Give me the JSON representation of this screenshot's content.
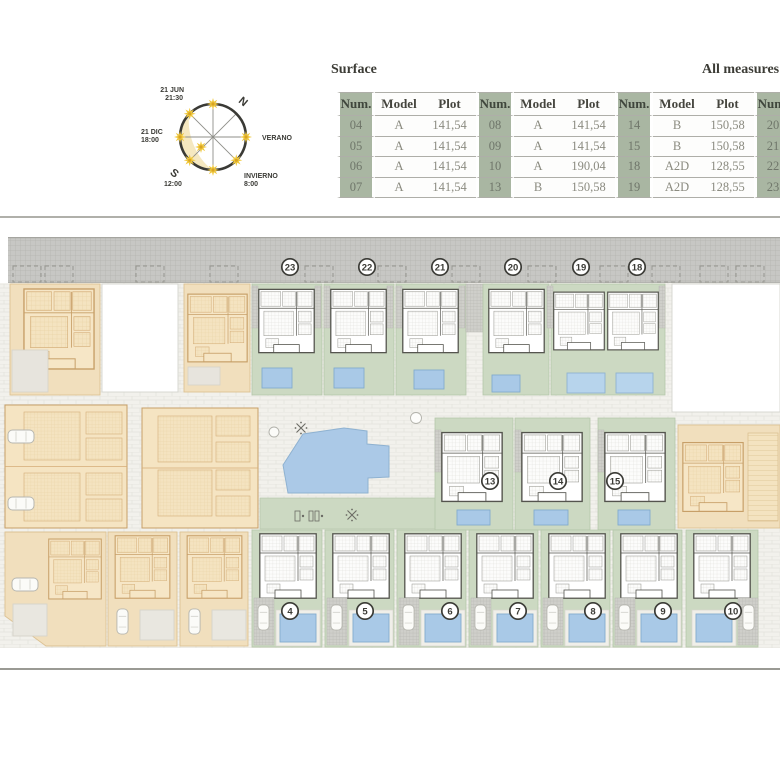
{
  "header": {
    "surface_label": "Surface",
    "measures_label": "All measures a"
  },
  "table": {
    "headers": [
      "Num.",
      "Model",
      "Plot",
      "Num.",
      "Model",
      "Plot",
      "Num.",
      "Model",
      "Plot",
      "Num."
    ],
    "rows": [
      [
        "04",
        "A",
        "141,54",
        "08",
        "A",
        "141,54",
        "14",
        "B",
        "150,58",
        "20"
      ],
      [
        "05",
        "A",
        "141,54",
        "09",
        "A",
        "141,54",
        "15",
        "B",
        "150,58",
        "21"
      ],
      [
        "06",
        "A",
        "141,54",
        "10",
        "A",
        "190,04",
        "18",
        "A2D",
        "128,55",
        "22"
      ],
      [
        "07",
        "A",
        "141,54",
        "13",
        "B",
        "150,58",
        "19",
        "A2D",
        "128,55",
        "23"
      ]
    ]
  },
  "compass": {
    "jun_date": "21 JUN",
    "jun_time": "21:30",
    "north": "N",
    "dic_date": "21 DIC",
    "dic_time": "18:00",
    "verano": "VERANO",
    "south": "S",
    "noon": "12:00",
    "invierno": "INVIERNO",
    "invierno_time": "8:00"
  },
  "plan": {
    "top_units": [
      "23",
      "22",
      "21",
      "20",
      "19",
      "18"
    ],
    "middle_units": [
      "13",
      "14",
      "15"
    ],
    "bottom_units": [
      "4",
      "5",
      "6",
      "7",
      "8",
      "9",
      "10"
    ]
  },
  "colors": {
    "table_green": "#a9b6a2",
    "lot_green": "#ccd9c2",
    "pool_blue": "#a9c9e7",
    "tan": "#f1dfbd",
    "road_gray": "#c7c7c4",
    "sun_yellow": "#f0c83c",
    "ink": "#3b3b36"
  }
}
